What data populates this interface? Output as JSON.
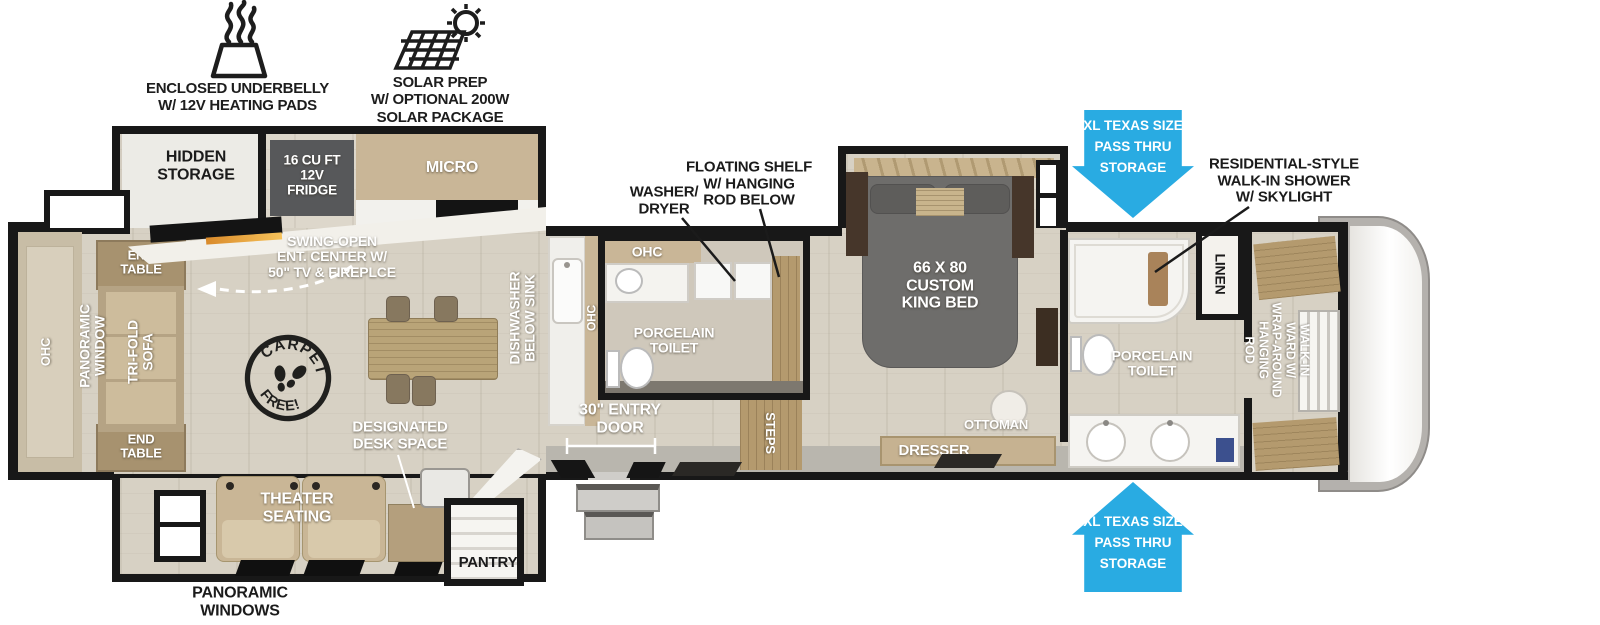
{
  "features": [
    {
      "icon": "heating-pads-icon",
      "label": "ENCLOSED UNDERBELLY\nW/ 12V HEATING PADS"
    },
    {
      "icon": "solar-panel-icon",
      "label": "SOLAR PREP\nW/ OPTIONAL 200W\nSOLAR PACKAGE"
    }
  ],
  "storage_arrows": {
    "top": "XL TEXAS SIZE\nPASS THRU\nSTORAGE",
    "bottom": "XL TEXAS SIZE\nPASS THRU\nSTORAGE"
  },
  "callouts": {
    "shower": "RESIDENTIAL-STYLE\nWALK-IN SHOWER\nW/ SKYLIGHT",
    "washer_dryer": "WASHER/\nDRYER",
    "floating_shelf": "FLOATING SHELF\nW/ HANGING\nROD BELOW",
    "panoramic_windows": "PANORAMIC\nWINDOWS"
  },
  "rooms": {
    "hidden_storage": "HIDDEN\nSTORAGE",
    "fridge": "16 CU FT\n12V\nFRIDGE",
    "micro": "MICRO",
    "ent_center": "SWING-OPEN\nENT. CENTER W/\n50\" TV & FIREPLCE",
    "dishwasher": "DISHWASHER\nBELOW SINK",
    "ohc_counter": "OHC",
    "ohc_bath": "OHC",
    "ohc_rear": "OHC",
    "porcelain_toilet_mid": "PORCELAIN\nTOILET",
    "porcelain_toilet_front": "PORCELAIN\nTOILET",
    "entry_door": "30\" ENTRY\nDOOR",
    "steps": "STEPS",
    "king_bed": "66 X 80\nCUSTOM\nKING BED",
    "ottoman": "OTTOMAN",
    "dresser": "DRESSER",
    "linen": "LINEN",
    "walk_in_ward": "WALK-IN\nWARD W/\nWRAP-AROUND\nHANGING\nROD",
    "panoramic_window": "PANORAMIC\nWINDOW",
    "tri_fold_sofa": "TRI-FOLD\nSOFA",
    "end_table_top": "END\nTABLE",
    "end_table_bottom": "END\nTABLE",
    "theater_seating": "THEATER\nSEATING",
    "designated_desk": "DESIGNATED\nDESK SPACE",
    "pantry": "PANTRY"
  },
  "stamp": {
    "top": "CARPET",
    "bottom": "FREE!"
  },
  "colors": {
    "accent_blue": "#29ABE2",
    "wall": "#181818",
    "floor": "#d7d1c4",
    "cabinet_tan": "#c9b697",
    "wood": "#b49a6e",
    "dark_wood": "#46362a",
    "bed_gray": "#6e6d6b",
    "fridge_gray": "#57585a",
    "entry_gray": "#b9b6ae"
  }
}
